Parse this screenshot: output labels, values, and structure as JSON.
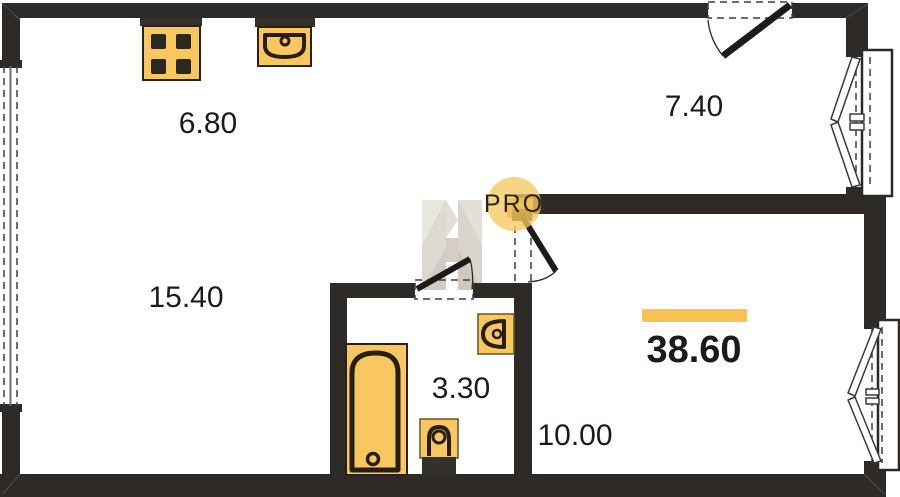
{
  "floorplan": {
    "watermark": {
      "badge_text": "PRO"
    },
    "areas": {
      "kitchen": "6.80",
      "hall": "7.40",
      "living": "15.40",
      "bathroom": "3.30",
      "room": "10.00",
      "total": "38.60"
    },
    "colors": {
      "wall": "#2e2a27",
      "fixture": "#f8c75f",
      "fixture_outline": "#2a211b",
      "highlight_bar": "#f6c34c",
      "badge_circle": "#f6c95f",
      "badge_text": "#8b8377"
    },
    "fixtures": [
      "stove-icon",
      "kitchen-sink-icon",
      "bathtub-icon",
      "toilet-icon",
      "washbasin-icon"
    ]
  }
}
